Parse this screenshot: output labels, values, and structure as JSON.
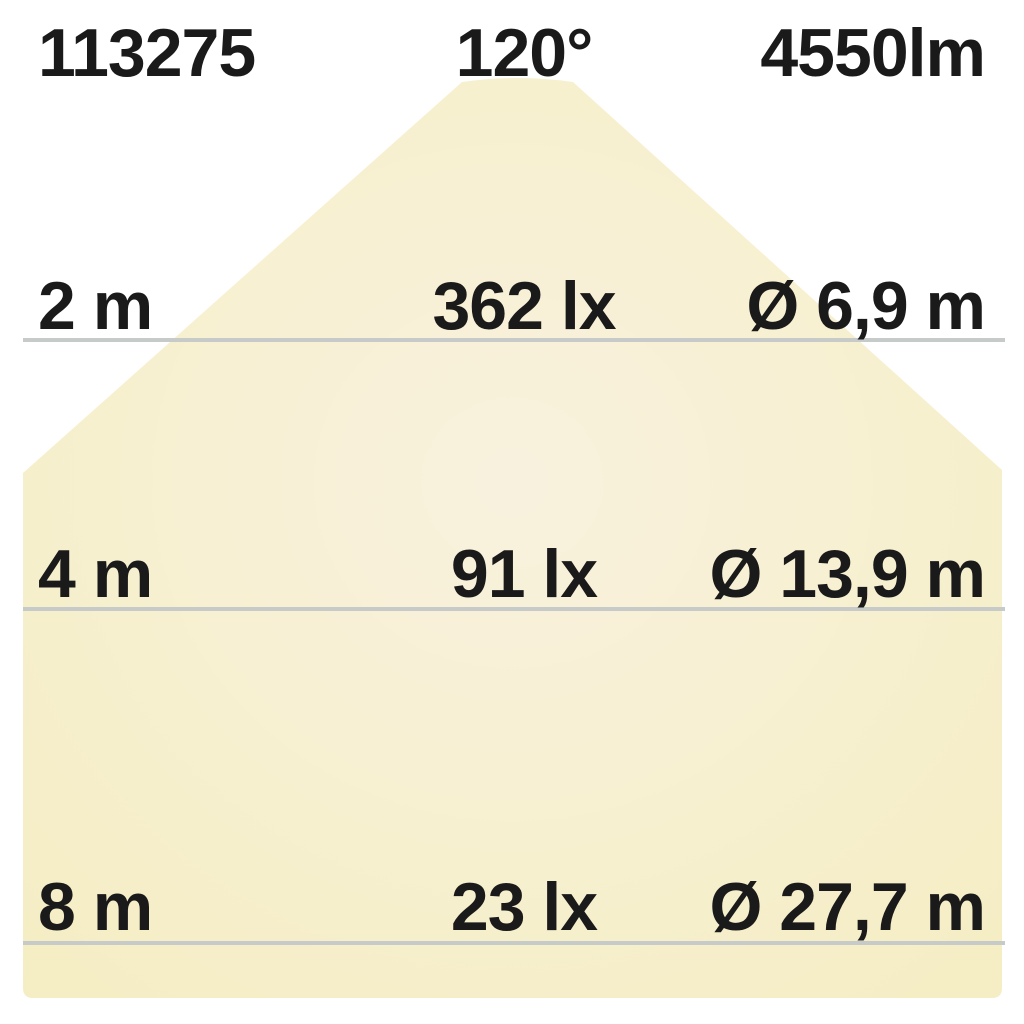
{
  "header": {
    "article_number": "113275",
    "beam_angle": "120°",
    "luminous_flux": "4550lm"
  },
  "rows": [
    {
      "distance": "2 m",
      "illuminance": "362 lx",
      "diameter": "Ø 6,9 m"
    },
    {
      "distance": "4 m",
      "illuminance": "91 lx",
      "diameter": "Ø 13,9 m"
    },
    {
      "distance": "8 m",
      "illuminance": "23 lx",
      "diameter": "Ø 27,7 m"
    }
  ],
  "colors": {
    "background": "#ffffff",
    "beam_center": "#f8f1de",
    "beam_mid": "#f7f0d0",
    "beam_edge": "#f5edc4",
    "line": "#c6cbc9",
    "text": "#1a1a1a"
  }
}
